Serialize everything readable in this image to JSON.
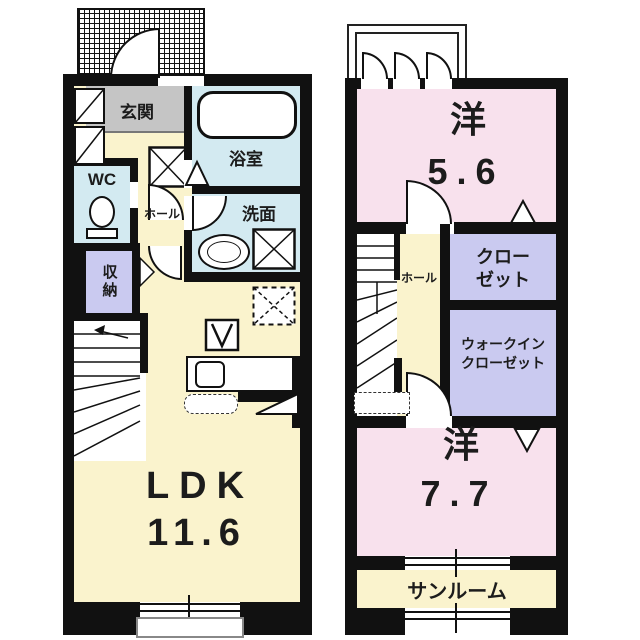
{
  "colors": {
    "wall": "#111111",
    "room_pink": "#f8e1ed",
    "room_yellow": "#faf3cd",
    "room_blue": "#d3eaf1",
    "room_purple": "#cacaf0",
    "genkan_gray": "#c5c5c5"
  },
  "floor1": {
    "genkan": "玄関",
    "bathroom": "浴室",
    "wc": "WC",
    "hall": "ホール",
    "washroom": "洗面",
    "storage": "収納",
    "ldk_name": "LDK",
    "ldk_size": "11.6"
  },
  "floor2": {
    "room_a_name": "洋",
    "room_a_size": "5.6",
    "closet_line1": "クロー",
    "closet_line2": "ゼット",
    "hall": "ホール",
    "wic_line1": "ウォークイン",
    "wic_line2": "クローゼット",
    "room_b_name": "洋",
    "room_b_size": "7.7",
    "sunroom": "サンルーム"
  }
}
